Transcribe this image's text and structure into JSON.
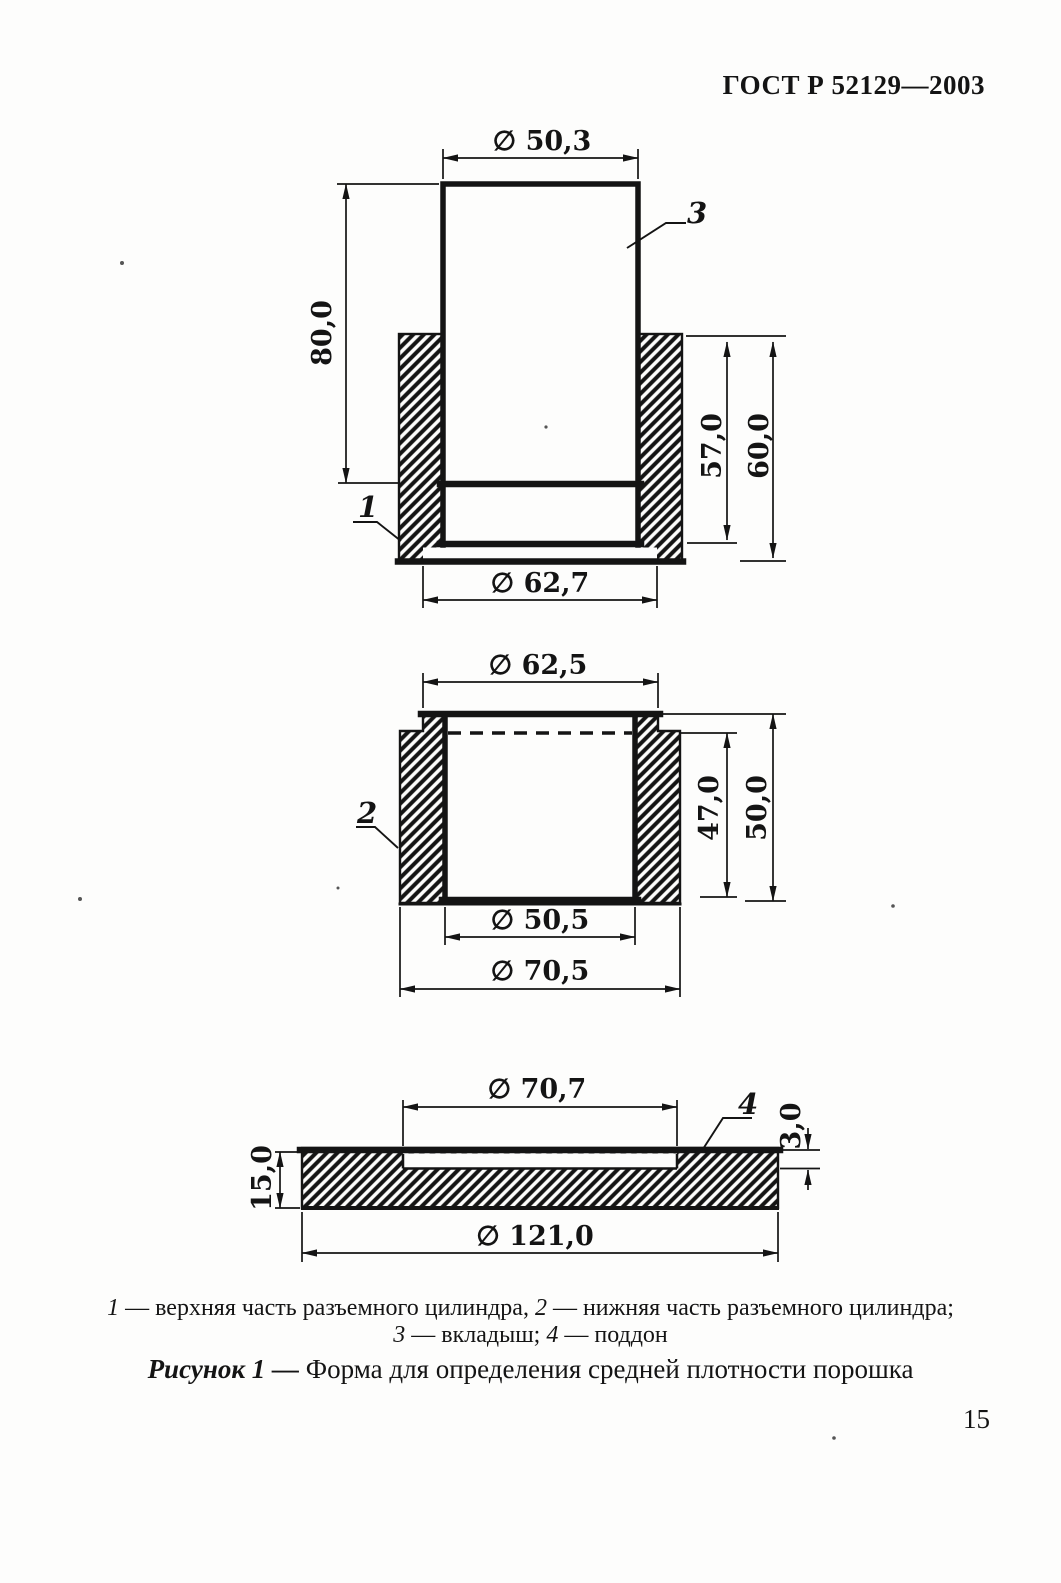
{
  "page": {
    "header": "ГОСТ Р 52129—2003",
    "number": "15"
  },
  "captions": {
    "item1_num": "1",
    "item1_text": " — верхняя часть разъемного цилиндра, ",
    "item2_num": "2",
    "item2_text": " — нижняя часть разъемного цилиндра;",
    "item3_num": "3",
    "item3_text": " — вкладыш; ",
    "item4_num": "4",
    "item4_text": " — поддон",
    "figure_label": "Рисунок 1 —",
    "figure_title": " Форма для определения средней плотности порошка"
  },
  "top_view": {
    "d50_3": "∅ 50,3",
    "h80": "80,0",
    "h57": "57,0",
    "h60": "60,0",
    "d62_7": "∅ 62,7",
    "part1": "1",
    "part3": "3"
  },
  "middle_view": {
    "d62_5": "∅ 62,5",
    "h47": "47,0",
    "h50": "50,0",
    "d50_5": "∅ 50,5",
    "d70_5": "∅ 70,5",
    "part2": "2"
  },
  "bottom_view": {
    "d70_7": "∅ 70,7",
    "h3": "3,0",
    "h15": "15,0",
    "d121": "∅ 121,0",
    "part4": "4"
  }
}
